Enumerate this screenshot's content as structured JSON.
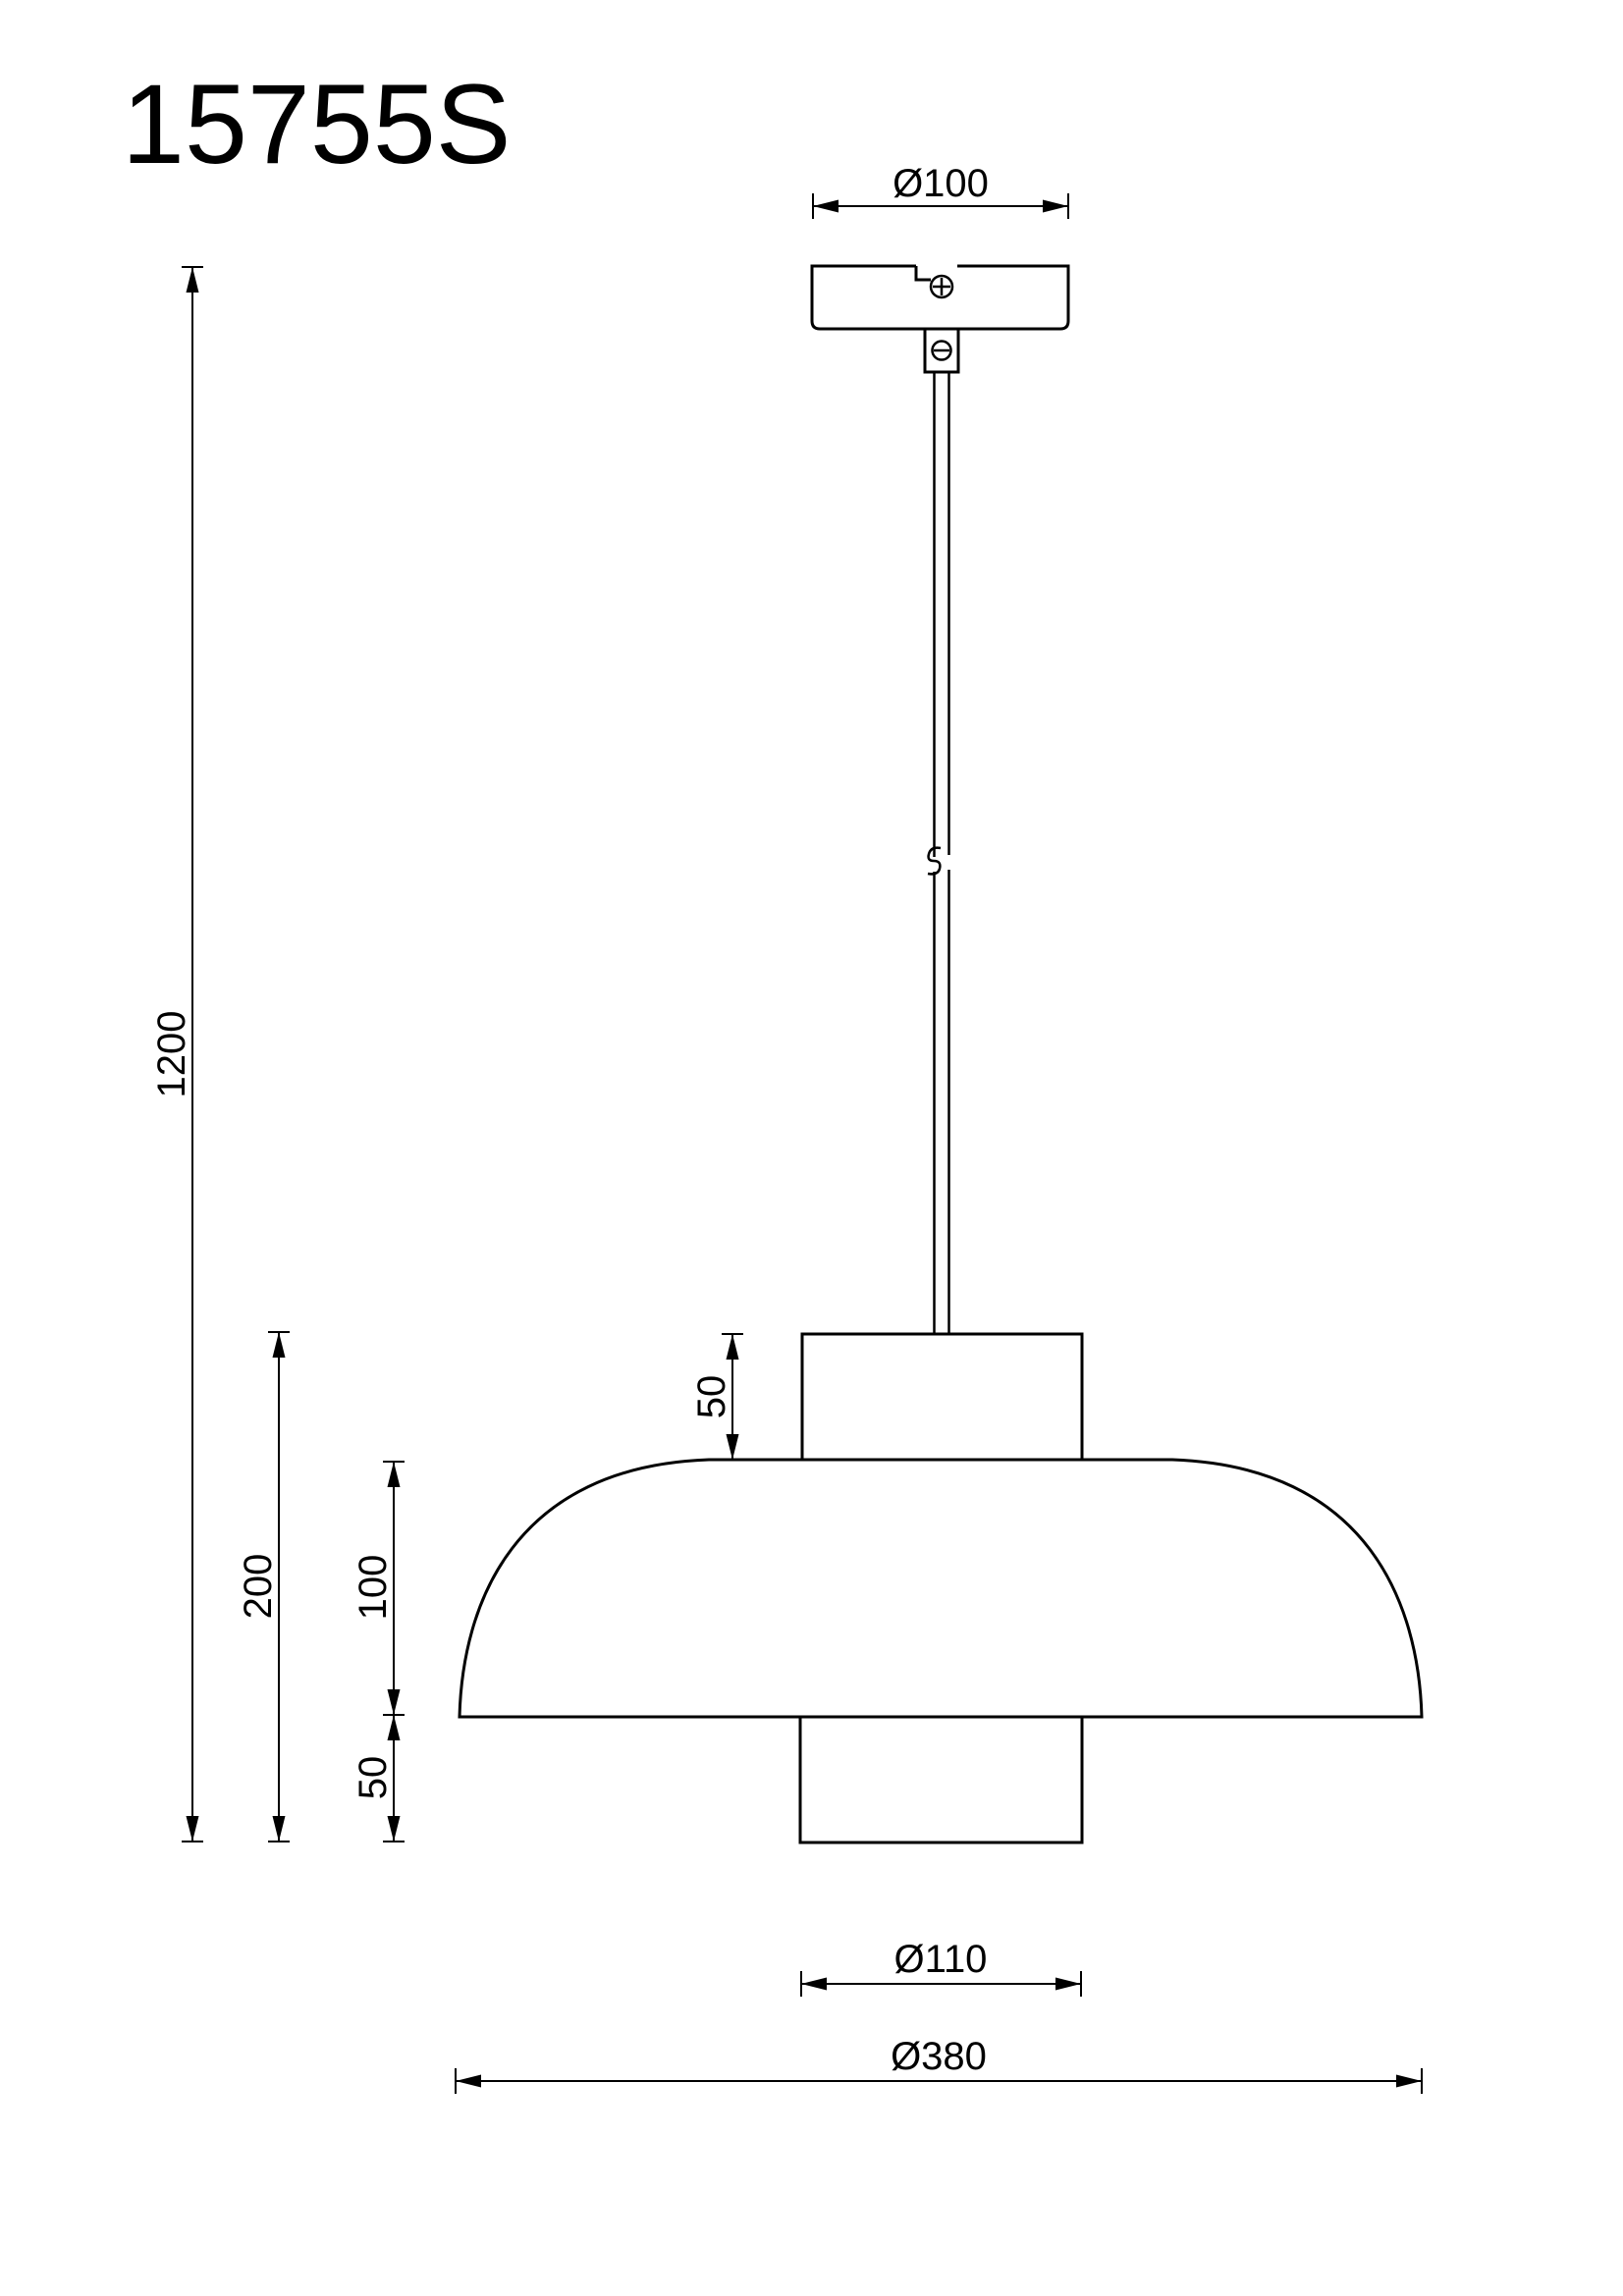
{
  "title": "15755S",
  "colors": {
    "line": "#000000",
    "background": "#ffffff"
  },
  "dims": {
    "canopy_diameter": "Ø100",
    "total_drop": "1200",
    "shade_height": "200",
    "dome_height": "100",
    "top_neck_height": "50",
    "bottom_neck_height": "50",
    "bottom_neck_diameter": "Ø110",
    "shade_diameter": "Ø380"
  },
  "icons": {
    "phillips_screw_icon": "circle-plus",
    "slotted_screw_icon": "circle-minus",
    "cable_break_icon": "s-break-squiggle"
  }
}
